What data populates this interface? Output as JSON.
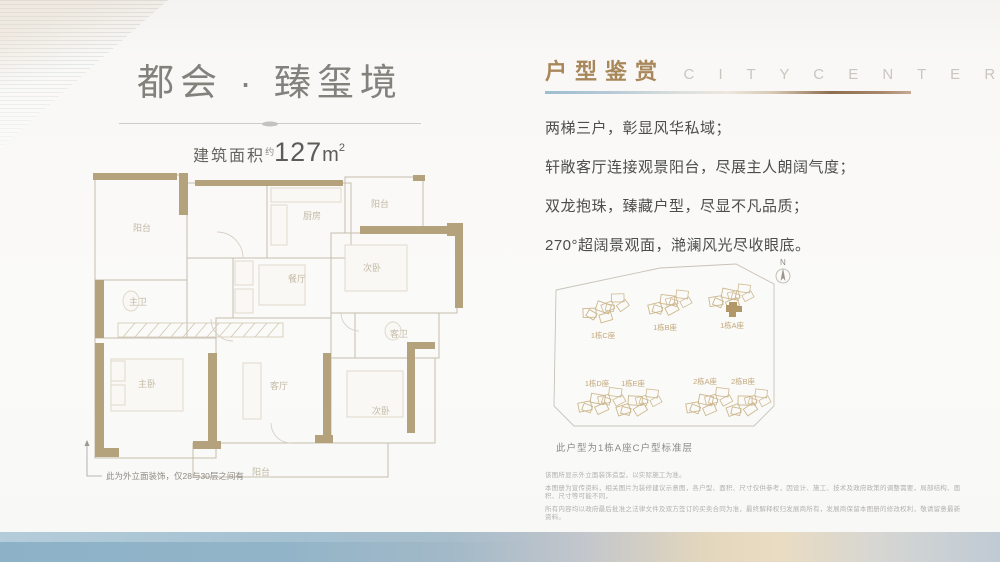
{
  "colors": {
    "accent_gold": "#a8875a",
    "wall_tan": "#b3a27c",
    "plan_line": "#c6beae",
    "site_label_tan": "#c2a678",
    "body_text": "#4d4d4d",
    "band_blue": "#8db2c7",
    "band_beige": "#e9dcc2"
  },
  "left": {
    "title": "都会 · 臻玺境",
    "area_label": "建筑面积",
    "area_approx": "约",
    "area_value": "127",
    "area_unit": "m",
    "area_exp": "2",
    "floorplan": {
      "rooms": {
        "balcony_tl": "阳台",
        "master_bath": "主卫",
        "master_bedroom": "主卧",
        "entry_kitchen": "厨房",
        "balcony_tr": "阳台",
        "bedroom_right": "次卧",
        "dining": "餐厅",
        "guest_bath": "客卫",
        "living": "客厅",
        "bedroom_br": "次卧",
        "balcony_bottom": "阳台"
      },
      "footnote": "此为外立面装饰，仅28与30层之间有"
    }
  },
  "right": {
    "header": {
      "title_cn": "户型鉴赏",
      "title_en": "C I T Y   C E N T E R"
    },
    "taglines": [
      "两梯三户，彰显风华私域；",
      "轩敞客厅连接观景阳台，尽展主人朗阔气度；",
      "双龙抱珠，臻藏户型，尽显不凡品质；",
      "270°超阔景观面，滟澜风光尽收眼底。"
    ],
    "siteplan": {
      "north_label": "N",
      "buildings": [
        "1栋C座",
        "1栋B座",
        "1栋A座",
        "1栋D座",
        "1栋E座",
        "2栋A座",
        "2栋B座"
      ],
      "caption": "此户型为1栋A座C户型标准层"
    },
    "disclaimer": [
      "该图所显示外立面装饰造型，以实际施工为准。",
      "本图册为宣传资料，相关图片为装修建议示意图，各户型、面积、尺寸仅供参考，因设计、施工、技术及政府政策的调整需要，局部结构、面积、尺寸等可能不同，",
      "所有内容均以政府最后批准之法律文件及双方签订的买卖合同为准，最终解释权归发展商所有，发展商保留本图册的修改权利，敬请留意最新资料。"
    ]
  }
}
